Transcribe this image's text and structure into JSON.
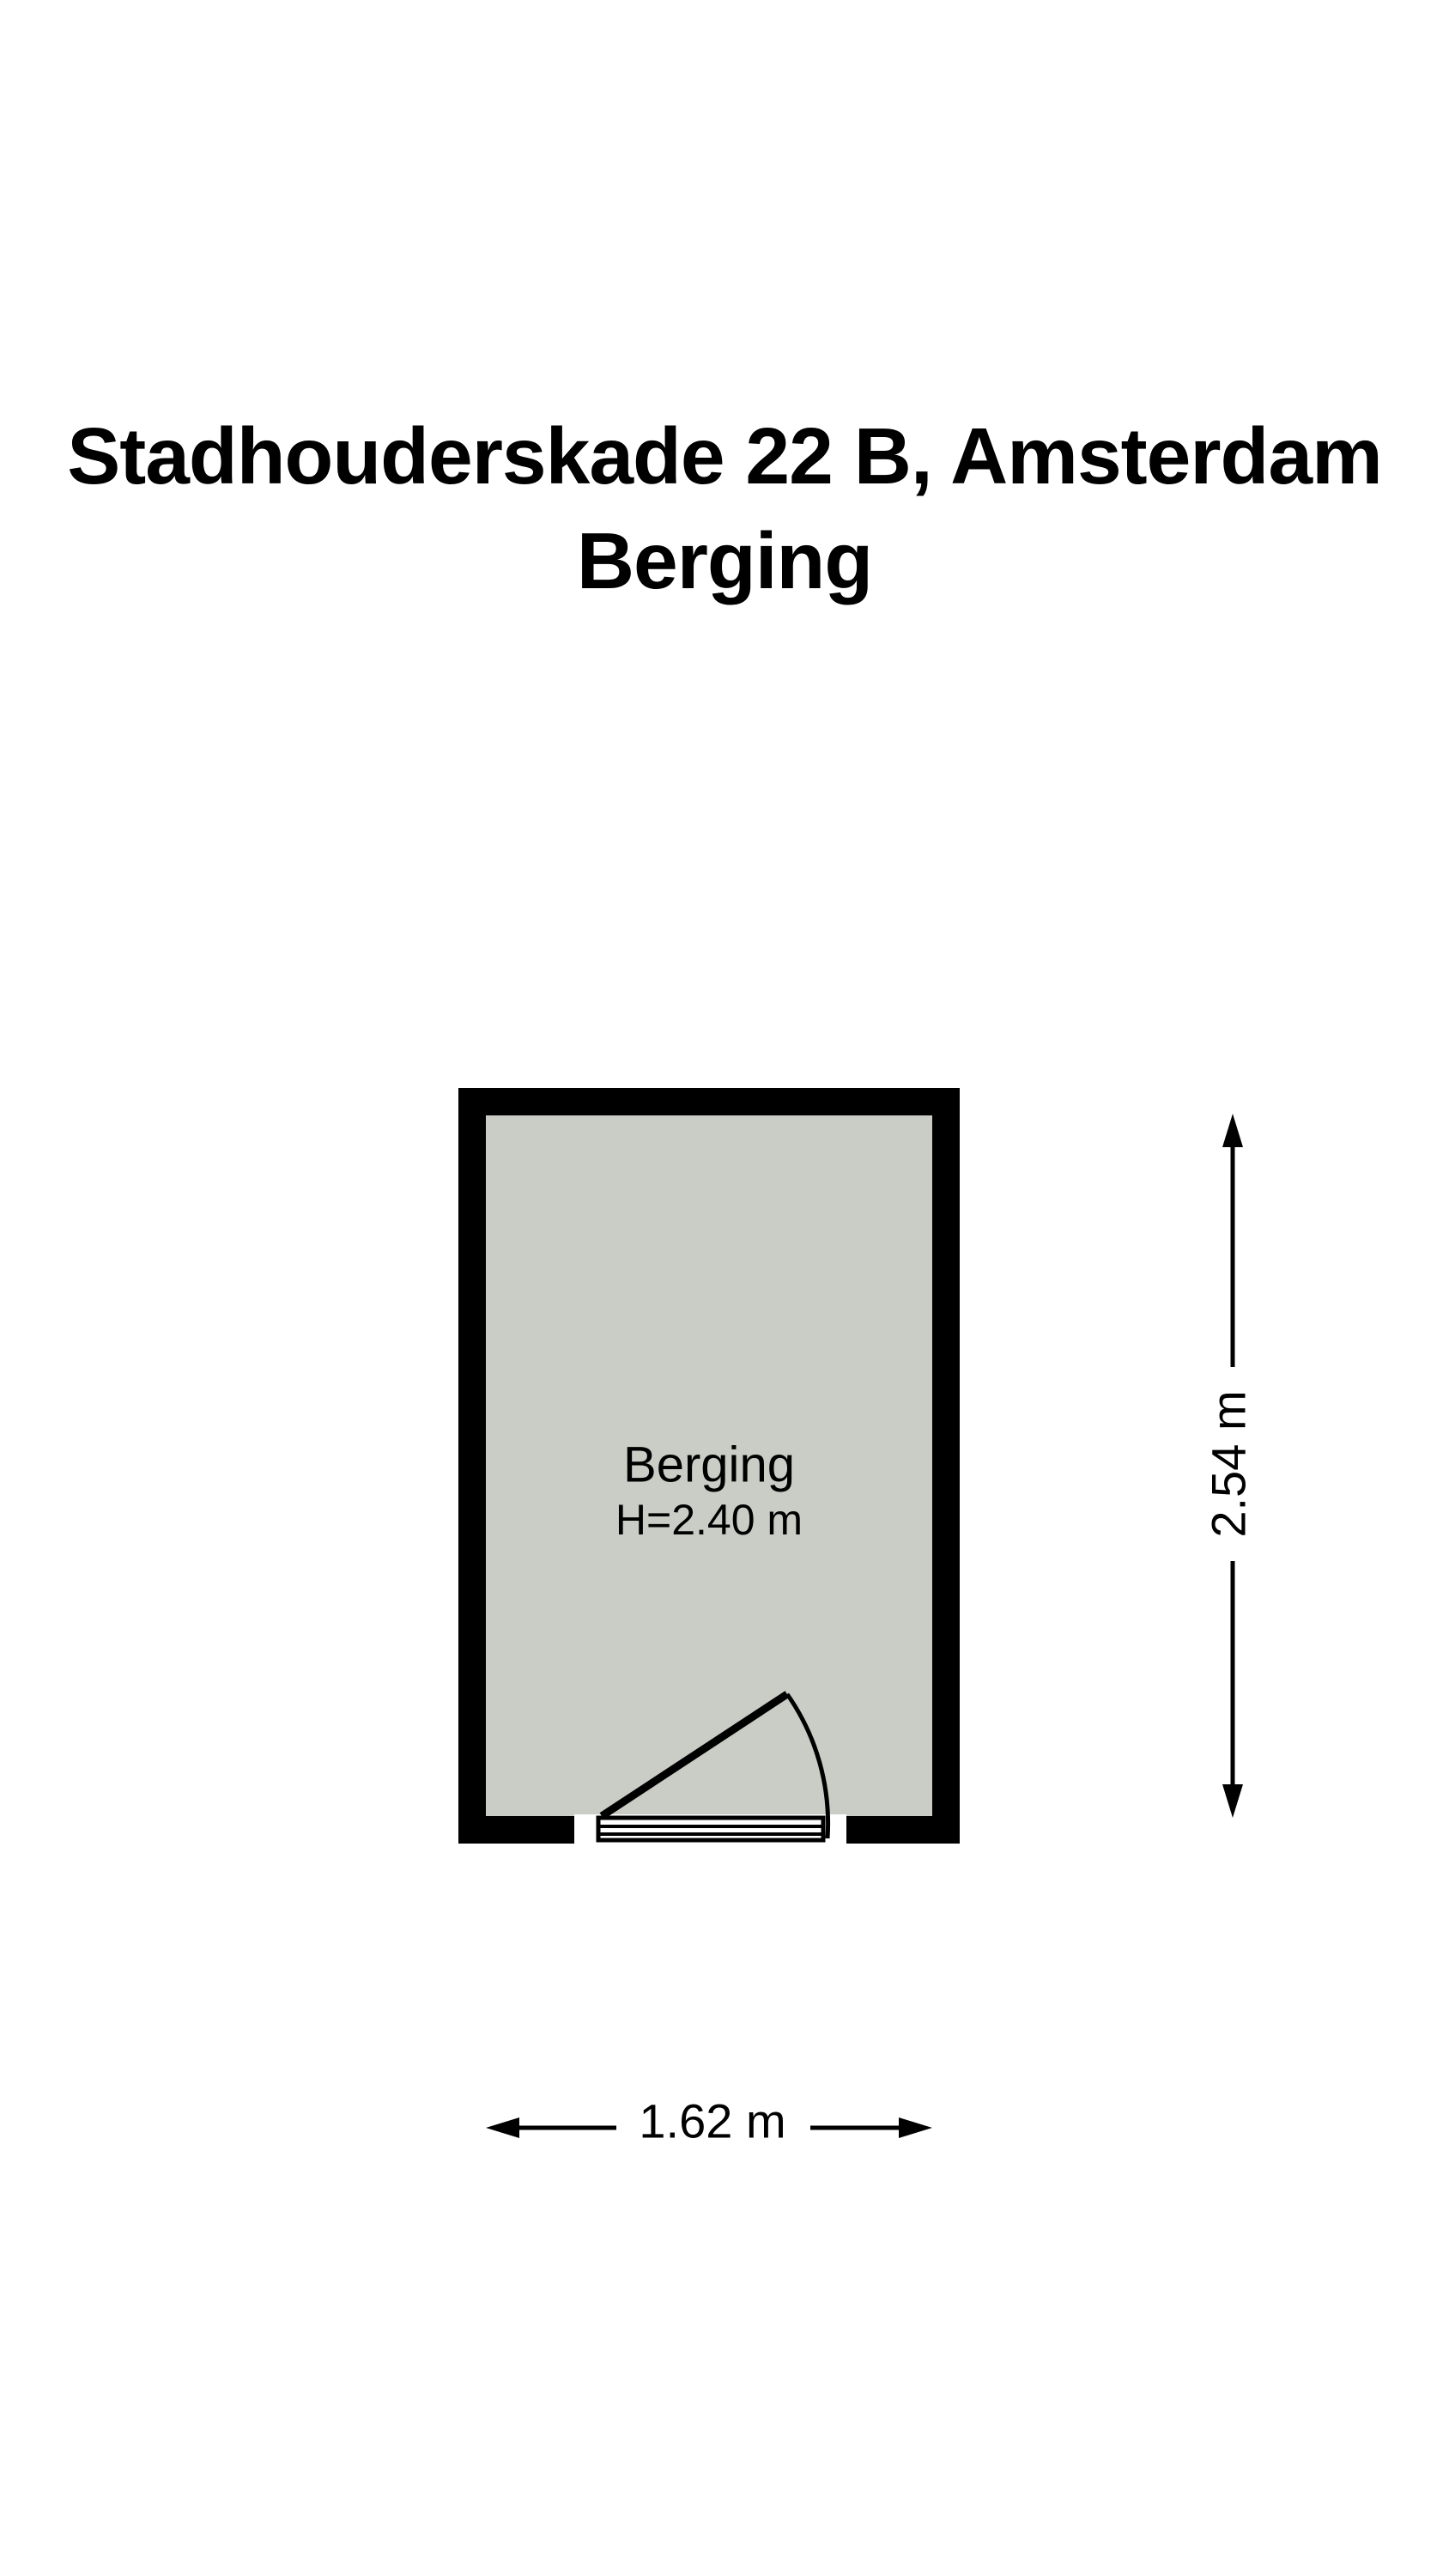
{
  "title": {
    "line1": "Stadhouderskade 22 B, Amsterdam",
    "line2": "Berging"
  },
  "floorplan": {
    "room": {
      "name": "Berging",
      "height_label": "H=2.40 m"
    },
    "dimensions": {
      "vertical": "2.54 m",
      "horizontal": "1.62 m"
    }
  },
  "colors": {
    "wall": "#000000",
    "floor": "#cacdc5",
    "line": "#000000",
    "background": "#ffffff"
  }
}
